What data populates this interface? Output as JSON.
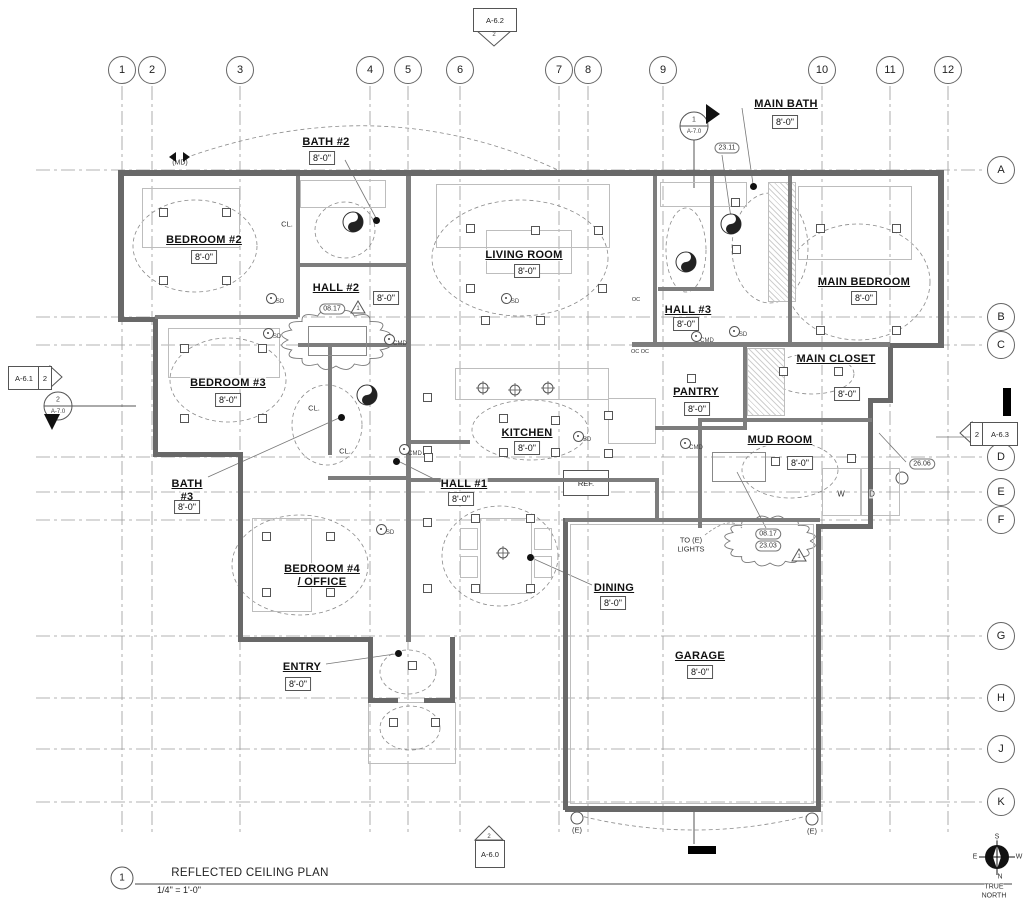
{
  "sheet": {
    "title_callout": {
      "number": "1",
      "title": "REFLECTED CEILING PLAN",
      "scale": "1/4\" = 1'-0\""
    },
    "north": {
      "top": "S",
      "left": "E",
      "right": "W",
      "bottom": "N",
      "caption_lines": [
        "TRUE",
        "NORTH"
      ]
    }
  },
  "grid": {
    "columns": [
      {
        "label": "1",
        "x": 122
      },
      {
        "label": "2",
        "x": 152
      },
      {
        "label": "3",
        "x": 240
      },
      {
        "label": "4",
        "x": 370
      },
      {
        "label": "5",
        "x": 408
      },
      {
        "label": "6",
        "x": 460
      },
      {
        "label": "7",
        "x": 559
      },
      {
        "label": "8",
        "x": 588
      },
      {
        "label": "9",
        "x": 663
      },
      {
        "label": "10",
        "x": 822
      },
      {
        "label": "11",
        "x": 890
      },
      {
        "label": "12",
        "x": 948
      }
    ],
    "rows": [
      {
        "label": "A",
        "y": 170
      },
      {
        "label": "B",
        "y": 317
      },
      {
        "label": "C",
        "y": 345
      },
      {
        "label": "D",
        "y": 457
      },
      {
        "label": "E",
        "y": 492
      },
      {
        "label": "F",
        "y": 520
      },
      {
        "label": "G",
        "y": 636
      },
      {
        "label": "H",
        "y": 698
      },
      {
        "label": "J",
        "y": 749
      },
      {
        "label": "K",
        "y": 802
      }
    ]
  },
  "markers": {
    "detail_refs": [
      {
        "id": "A-6.2",
        "detail": "2",
        "dir": "down",
        "x": 494,
        "y": 20
      },
      {
        "id": "A-6.1",
        "detail": "2",
        "dir": "right",
        "x": 26,
        "y": 377
      },
      {
        "id": "A-6.3",
        "detail": "2",
        "dir": "left",
        "x": 980,
        "y": 433
      },
      {
        "id": "A-6.0",
        "detail": "2",
        "dir": "up",
        "x": 489,
        "y": 850
      }
    ],
    "sections": [
      {
        "num": "1",
        "sheet": "A-7.0",
        "dir": "right",
        "x": 694,
        "y": 126
      },
      {
        "num": "2",
        "sheet": "A-7.0",
        "dir": "down",
        "x": 58,
        "y": 406
      }
    ]
  },
  "rooms": [
    {
      "lines": [
        "BEDROOM #2"
      ],
      "height": "8'-0\"",
      "lx": 204,
      "ly": 240,
      "tx": 204,
      "ty": 257
    },
    {
      "lines": [
        "BATH #2"
      ],
      "height": "8'-0\"",
      "lx": 326,
      "ly": 142,
      "tx": 322,
      "ty": 158
    },
    {
      "lines": [
        "HALL #2"
      ],
      "height": "8'-0\"",
      "lx": 336,
      "ly": 288,
      "tx": 386,
      "ty": 298
    },
    {
      "lines": [
        "BEDROOM #3"
      ],
      "height": "8'-0\"",
      "lx": 228,
      "ly": 383,
      "tx": 228,
      "ty": 400
    },
    {
      "lines": [
        "BATH",
        "#3"
      ],
      "height": "8'-0\"",
      "lx": 187,
      "ly": 484,
      "tx": 187,
      "ty": 507
    },
    {
      "lines": [
        "HALL #1"
      ],
      "height": "8'-0\"",
      "lx": 464,
      "ly": 484,
      "tx": 461,
      "ty": 499
    },
    {
      "lines": [
        "BEDROOM #4",
        "/ OFFICE"
      ],
      "height": null,
      "lx": 322,
      "ly": 569,
      "tx": null,
      "ty": null
    },
    {
      "lines": [
        "ENTRY"
      ],
      "height": "8'-0\"",
      "lx": 302,
      "ly": 667,
      "tx": 298,
      "ty": 684
    },
    {
      "lines": [
        "LIVING ROOM"
      ],
      "height": "8'-0\"",
      "lx": 524,
      "ly": 255,
      "tx": 527,
      "ty": 271
    },
    {
      "lines": [
        "KITCHEN"
      ],
      "height": "8'-0\"",
      "lx": 527,
      "ly": 433,
      "tx": 527,
      "ty": 448
    },
    {
      "lines": [
        "DINING"
      ],
      "height": "8'-0\"",
      "lx": 614,
      "ly": 588,
      "tx": 613,
      "ty": 603
    },
    {
      "lines": [
        "PANTRY"
      ],
      "height": "8'-0\"",
      "lx": 696,
      "ly": 392,
      "tx": 697,
      "ty": 409
    },
    {
      "lines": [
        "HALL #3"
      ],
      "height": "8'-0\"",
      "lx": 688,
      "ly": 310,
      "tx": 686,
      "ty": 324
    },
    {
      "lines": [
        "MAIN BATH"
      ],
      "height": "8'-0\"",
      "lx": 786,
      "ly": 104,
      "tx": 785,
      "ty": 122
    },
    {
      "lines": [
        "MAIN BEDROOM"
      ],
      "height": "8'-0\"",
      "lx": 864,
      "ly": 282,
      "tx": 864,
      "ty": 298
    },
    {
      "lines": [
        "MAIN CLOSET"
      ],
      "height": "8'-0\"",
      "lx": 836,
      "ly": 359,
      "tx": 847,
      "ty": 394
    },
    {
      "lines": [
        "MUD ROOM"
      ],
      "height": "8'-0\"",
      "lx": 780,
      "ly": 440,
      "tx": 800,
      "ty": 463
    },
    {
      "lines": [
        "GARAGE"
      ],
      "height": "8'-0\"",
      "lx": 700,
      "ly": 656,
      "tx": 700,
      "ty": 672
    }
  ],
  "notes": [
    {
      "text": "CL.",
      "x": 287,
      "y": 224,
      "size": 7.5
    },
    {
      "text": "CL.",
      "x": 314,
      "y": 408,
      "size": 7.5
    },
    {
      "text": "CL.",
      "x": 345,
      "y": 451,
      "size": 7.5
    },
    {
      "text": "(MD)",
      "x": 180,
      "y": 163,
      "size": 7
    },
    {
      "text": "W",
      "x": 841,
      "y": 494,
      "size": 8
    },
    {
      "text": "D",
      "x": 872,
      "y": 494,
      "size": 8
    },
    {
      "text": "OC  OC",
      "x": 640,
      "y": 352,
      "size": 5.5
    },
    {
      "text": "OC",
      "x": 636,
      "y": 300,
      "size": 5.5
    },
    {
      "text": "TO (E)",
      "x": 691,
      "y": 540,
      "size": 7.5
    },
    {
      "text": "LIGHTS",
      "x": 691,
      "y": 549,
      "size": 7.5
    },
    {
      "text": "(E)",
      "x": 577,
      "y": 830,
      "size": 7.5
    },
    {
      "text": "(E)",
      "x": 812,
      "y": 831,
      "size": 7.5
    }
  ],
  "ref_label": "REF.",
  "keynote_tags": [
    {
      "text": "23.11",
      "x": 727,
      "y": 148
    },
    {
      "text": "26.06",
      "x": 922,
      "y": 464
    },
    {
      "text": "08.17",
      "x": 332,
      "y": 309
    },
    {
      "text": "08.17",
      "x": 768,
      "y": 534
    },
    {
      "text": "23.03",
      "x": 768,
      "y": 546
    }
  ],
  "revision_triangles": [
    {
      "num": "1",
      "x": 358,
      "y": 308
    },
    {
      "num": "1",
      "x": 799,
      "y": 556
    }
  ],
  "detectors": {
    "sd": {
      "label": "SD",
      "points": [
        [
          270,
          297
        ],
        [
          267,
          332
        ],
        [
          505,
          297
        ],
        [
          577,
          435
        ],
        [
          380,
          528
        ],
        [
          733,
          330
        ]
      ]
    },
    "cmd": {
      "label": "CMD",
      "points": [
        [
          388,
          338
        ],
        [
          403,
          448
        ],
        [
          684,
          442
        ],
        [
          695,
          335
        ]
      ]
    }
  }
}
